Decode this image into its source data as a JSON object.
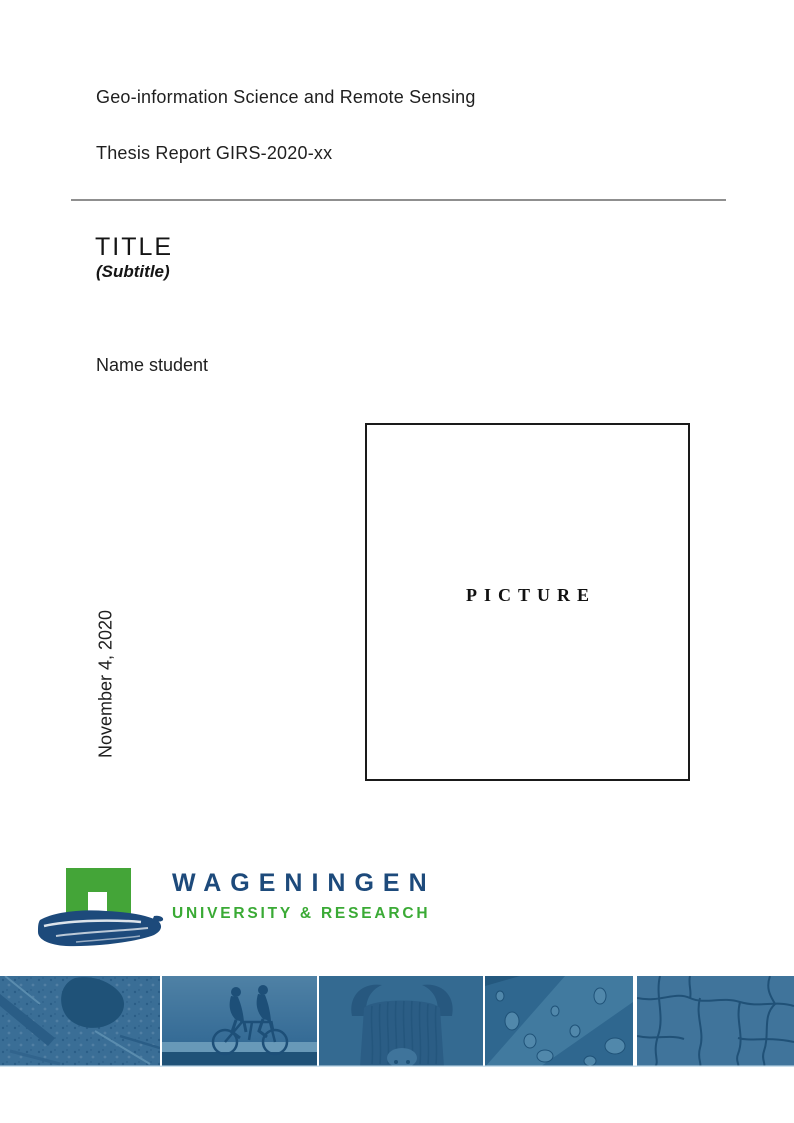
{
  "header": {
    "program": "Geo-information Science and Remote Sensing",
    "report": "Thesis Report GIRS-2020-xx"
  },
  "title_block": {
    "title": "TITLE",
    "subtitle": "(Subtitle)"
  },
  "author": {
    "name": "Name student"
  },
  "date": {
    "text": "November 4, 2020"
  },
  "picture_placeholder": {
    "label": "PICTURE"
  },
  "logo": {
    "line1": "WAGENINGEN",
    "line2": "UNIVERSITY & RESEARCH",
    "colors": {
      "brand_green": "#44a538",
      "brand_blue": "#1d4a7b"
    }
  },
  "footer_banner": {
    "overlay_blue": "#336a93",
    "photos": [
      "aerial-map",
      "tandem-cyclists",
      "highland-cow",
      "water-droplets",
      "cracked-earth"
    ]
  }
}
